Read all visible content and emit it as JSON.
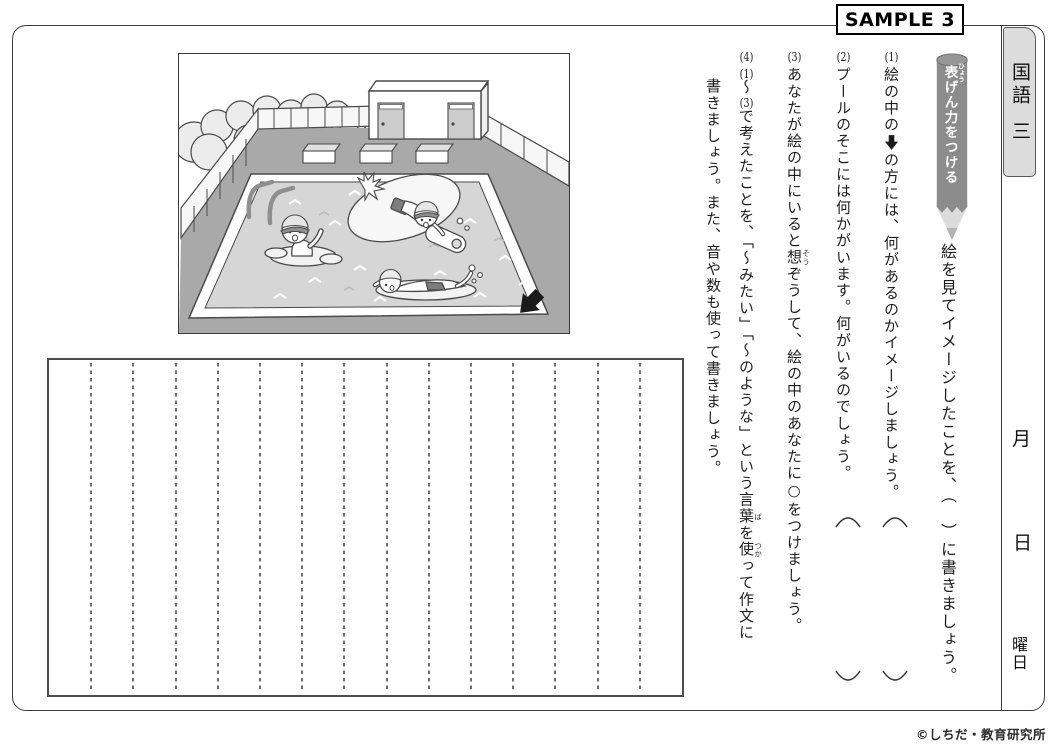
{
  "sample_label": "SAMPLE 3",
  "subject_tab": {
    "subject": "国語",
    "grade": "三"
  },
  "date_labels": {
    "month": "月",
    "day": "日",
    "weekday": "曜日"
  },
  "banner": {
    "ruby_base": "表",
    "ruby_text": "ひょう",
    "rest": "げん力をつける"
  },
  "headline": "絵を見てイメージしたことを、（　）に書きましょう。",
  "questions": {
    "q1": {
      "num": "(1)",
      "pre": "絵の中の",
      "arrow_icon": "black-down-arrow",
      "post": "の方には、何があるのかイメージしましょう。",
      "answer_bracket": "（　）"
    },
    "q2": {
      "num": "(2)",
      "text": "プールのそこには何かがいます。何がいるのでしょう。",
      "answer_bracket": "（　）"
    },
    "q3": {
      "num": "(3)",
      "pre": "あなたが絵の中にいると",
      "ruby_base": "想",
      "ruby_text": "そう",
      "post": "ぞうして、絵の中のあなたに○をつけましょう。"
    },
    "q4": {
      "num": "(4)",
      "range_start": "(1)",
      "range_tilde": "～",
      "range_end": "(3)",
      "seg1": "で考えたことを、「～みたい」「～のような」という言",
      "ruby1_base": "葉",
      "ruby1_text": "ば",
      "seg2": "を",
      "ruby2_base": "使",
      "ruby2_text": "つか",
      "seg3": "って作文に",
      "line2": "書きましょう。また、音や数も使って書きましょう。"
    }
  },
  "writing_grid": {
    "columns": 15
  },
  "illustration": {
    "description": "outdoor swimming pool scene with three children (one waving, one on a kickboard, one swimming crawl), starting blocks, pool ladder, changing-room building with two doors, perimeter fence, bushes, and a black arrow pointing to the bottom-right corner of the pool"
  },
  "copyright": "©しちだ・教育研究所",
  "colors": {
    "banner_body": "#8c8c8c",
    "banner_tip": "#d9d9d9",
    "subject_tab_bg": "#dcdcdc",
    "deck_gray": "#a9a9a9",
    "water_gray": "#d6d6d6",
    "arrow_black": "#1a1a1a"
  }
}
